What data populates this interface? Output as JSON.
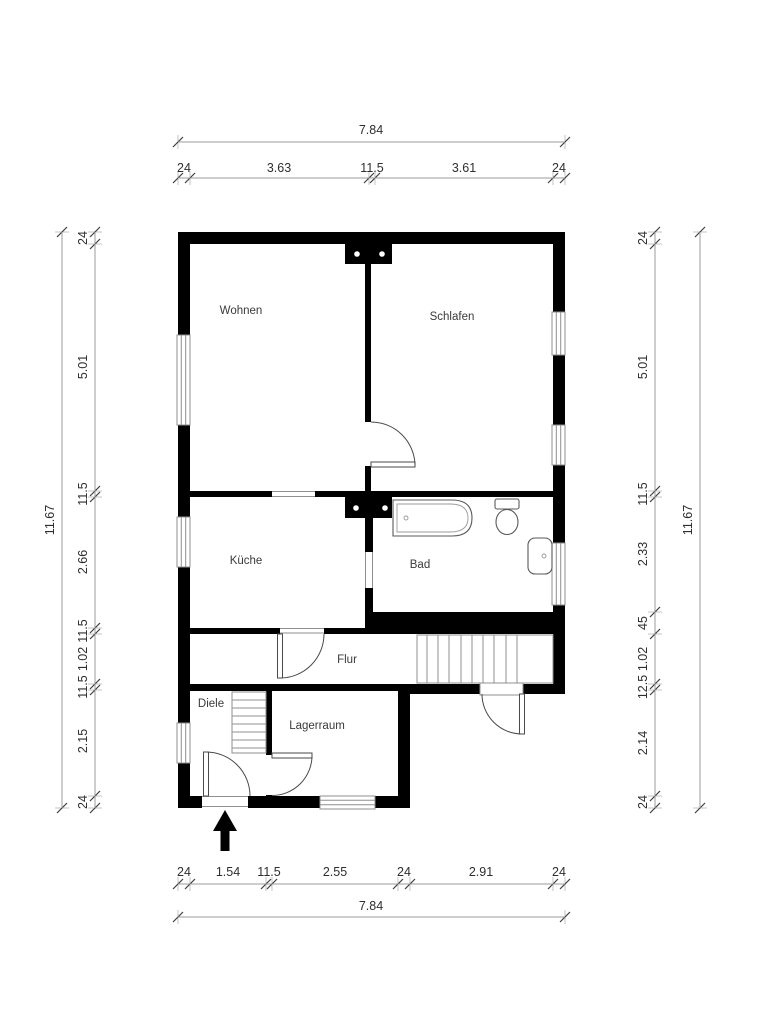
{
  "rooms": {
    "wohnen": {
      "label": "Wohnen"
    },
    "schlafen": {
      "label": "Schlafen"
    },
    "kueche": {
      "label": "Küche"
    },
    "bad": {
      "label": "Bad"
    },
    "flur": {
      "label": "Flur"
    },
    "diele": {
      "label": "Diele"
    },
    "lagerraum": {
      "label": "Lagerraum"
    }
  },
  "dimensions": {
    "top": {
      "total": "7.84",
      "segments": [
        "24",
        "3.63",
        "11.5",
        "3.61",
        "24"
      ]
    },
    "bottom": {
      "total": "7.84",
      "segments": [
        "24",
        "1.54",
        "11.5",
        "2.55",
        "24",
        "2.91",
        "24"
      ]
    },
    "left": {
      "total": "11.67",
      "segments": [
        "24",
        "5.01",
        "11.5",
        "2.66",
        "11.5",
        "1.02",
        "11.5",
        "2.15",
        "24"
      ]
    },
    "right": {
      "total": "11.67",
      "segments": [
        "24",
        "5.01",
        "11.5",
        "2.33",
        "45",
        "1.02",
        "12.5",
        "2.14",
        "24"
      ]
    }
  },
  "symbols": {
    "entrance_arrow": "entrance-direction-arrow",
    "chimneys": [
      "chimney-top",
      "chimney-middle"
    ],
    "stairs": [
      "stairs-flur",
      "stairs-diele"
    ],
    "bath_fixtures": [
      "bathtub",
      "toilet",
      "washbasin"
    ]
  },
  "colors": {
    "wall": "#000000",
    "dim_line": "#9b9b9b",
    "text": "#2e2e2e",
    "background": "#ffffff"
  }
}
